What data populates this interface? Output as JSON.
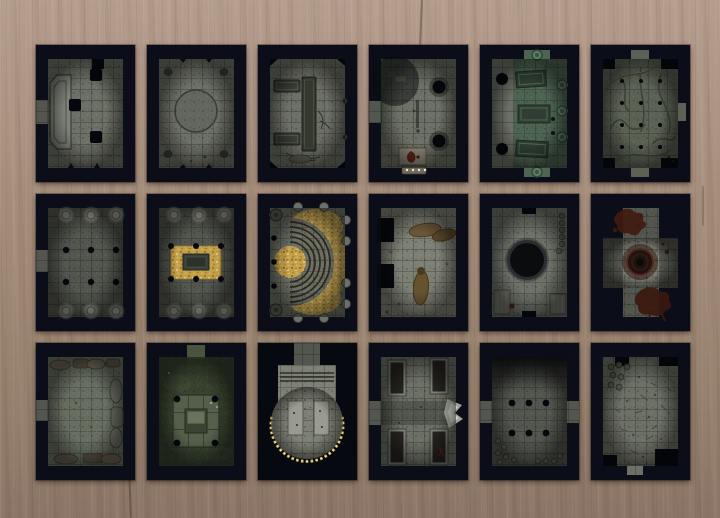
{
  "app": {
    "title": "Dungeon map tile set laid out on a wooden table",
    "board_rows": 3,
    "board_cols": 6,
    "tile_count": 18
  },
  "palette": {
    "wood_top": "#b59d8d",
    "wood_bottom": "#8b7566",
    "tile_frame": "#0b0e19",
    "stone_mid": "#6d7066",
    "stone_dark": "#53564e",
    "stone_light": "#7d8075",
    "green_marble": "#4e6452",
    "moss_green": "#37422f",
    "gold": "#c3a049",
    "blood_red": "#401a10",
    "glow": "#e8e6d2"
  },
  "tiles": [
    {
      "id": 1,
      "name": "ruined-hall-pits",
      "description": "Stone hall with a raised dais on the left, three square pit holes and a west door"
    },
    {
      "id": 2,
      "name": "circle-chamber",
      "description": "Stone chamber with a large inscribed circle in the center and rubble in the corners"
    },
    {
      "id": 3,
      "name": "crypt-benches",
      "description": "Crypt with dark stone benches and cracked flagstones"
    },
    {
      "id": 4,
      "name": "pit-shrine",
      "description": "Chamber with two round pits, dark stains and a blood-marked altar with candles at the south edge"
    },
    {
      "id": 5,
      "name": "green-marble-crypt",
      "description": "Green marble crypt with three sarcophagi, round medallions and two pit holes"
    },
    {
      "id": 6,
      "name": "root-ossuary",
      "description": "Wide chamber overgrown with carved roots and branches, dotted with small holes"
    },
    {
      "id": 7,
      "name": "dark-pillared-hall",
      "description": "Dark hall with six glowing-topped pillars and a west passage"
    },
    {
      "id": 8,
      "name": "pillared-treasure-vault",
      "description": "Pillared vault with a central heap of gold coins around a dark sarcophagus"
    },
    {
      "id": 9,
      "name": "golden-amphitheater",
      "description": "Semicircular tiered steps opening west, surrounded by scattered gold"
    },
    {
      "id": 10,
      "name": "corpse-chamber",
      "description": "Pale stone room with brown corpses or debris piles and two west alcoves"
    },
    {
      "id": 11,
      "name": "well-chamber",
      "description": "Chamber with a large round black well, coin stacks along the east wall and carved floor panels"
    },
    {
      "id": 12,
      "name": "blood-ritual-cross",
      "description": "Cross-shaped room with a dark ritual circle and large blood splatters"
    },
    {
      "id": 13,
      "name": "rubble-hall",
      "description": "Hall edged with collapsed masonry and broken pillars, west door"
    },
    {
      "id": 14,
      "name": "moss-altar-room",
      "description": "Moss-green room with a raised central platform, altar table and four corner post holes"
    },
    {
      "id": 15,
      "name": "round-lit-dais",
      "description": "Great round dais rimmed with candles, two pale slabs and steps from a north corridor"
    },
    {
      "id": 16,
      "name": "crypt-barracks",
      "description": "Room with four dark bed-like niches, a central east-west corridor and a pale figure at the east wall"
    },
    {
      "id": 17,
      "name": "dark-pillar-crossing",
      "description": "Shadowy crossing with six post holes, side passages and scattered coins"
    },
    {
      "id": 18,
      "name": "bone-strewn-chamber",
      "description": "Chamber littered with bones and debris, coin rings in the northwest corner"
    }
  ]
}
